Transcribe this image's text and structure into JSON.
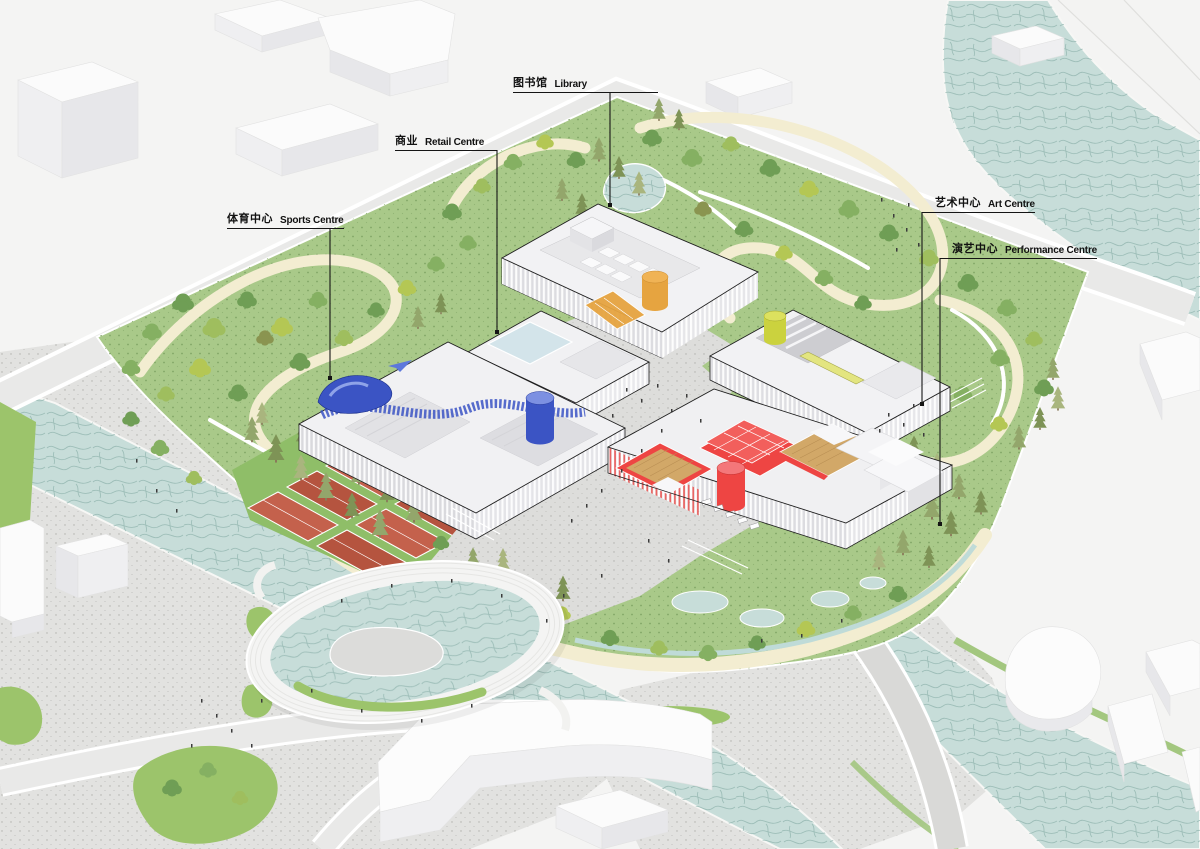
{
  "meta": {
    "view": "axonometric-site-plan",
    "subject": "cultural and sports park with five labelled venues"
  },
  "labels": {
    "library": {
      "zh": "图书馆",
      "en": "Library"
    },
    "retail": {
      "zh": "商业",
      "en": "Retail Centre"
    },
    "sports": {
      "zh": "体育中心",
      "en": "Sports Centre"
    },
    "art": {
      "zh": "艺术中心",
      "en": "Art Centre"
    },
    "performance": {
      "zh": "演艺中心",
      "en": "Performance Centre"
    }
  },
  "colors": {
    "sports_accent": "#3B54C4",
    "library_accent": "#E6A440",
    "retail_accent": "#9A5FB0",
    "art_accent": "#CBD23E",
    "performance_accent": "#EE4543",
    "water": "#C7DDD9",
    "park_green": "#A9C989",
    "path_cream": "#F3EDD1",
    "court_clay": "#C4614C",
    "plaza_grey": "#E2E2E0",
    "road_grey": "#E9E9E8"
  }
}
